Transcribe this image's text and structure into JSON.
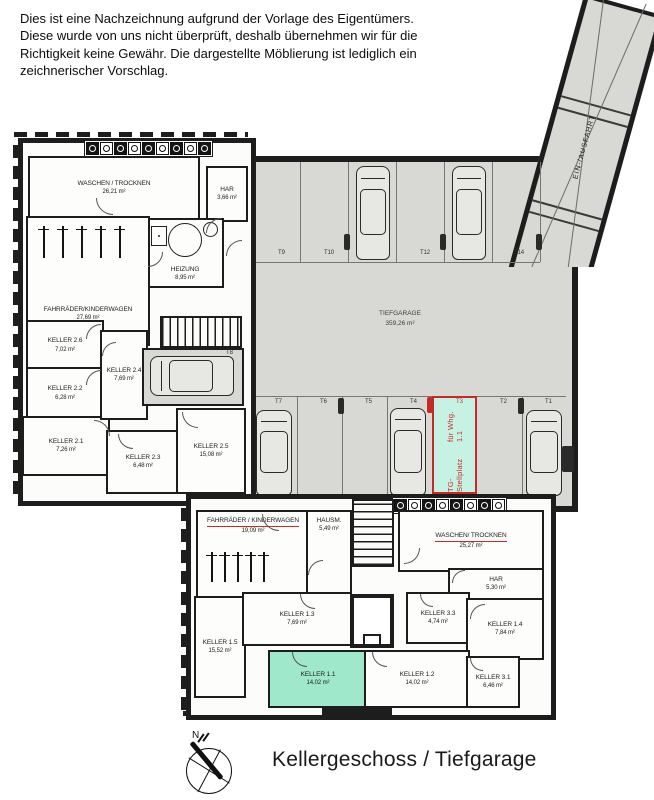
{
  "disclaimer": {
    "lines": [
      "Dies ist eine Nachzeichnung aufgrund der Vorlage des Eigentümers.",
      "Diese wurde von uns nicht überprüft, deshalb übernehmen wir für die",
      "Richtigkeit keine Gewähr. Die dargestellte Möblierung ist lediglich ein",
      "zeichnerischer Vorschlag."
    ]
  },
  "plan_title": "Kellergeschoss / Tiefgarage",
  "compass": {
    "north": "N"
  },
  "upper": {
    "rooms": [
      {
        "name": "WASCHEN / TROCKNEN",
        "area": "26,21 m²"
      },
      {
        "name": "HAR",
        "area": "3,66 m²"
      },
      {
        "name": "HEIZUNG",
        "area": "8,95 m²"
      },
      {
        "name": "FAHRRÄDER/KINDERWAGEN",
        "area": "27,69 m²"
      },
      {
        "name": "KELLER 2.6",
        "area": "7,02 m²"
      },
      {
        "name": "KELLER 2.2",
        "area": "6,28 m²"
      },
      {
        "name": "KELLER 2.1",
        "area": "7,26 m²"
      },
      {
        "name": "KELLER 2.3",
        "area": "6,48 m²"
      },
      {
        "name": "KELLER 2.4",
        "area": "7,69 m²"
      },
      {
        "name": "KELLER 2.5",
        "area": "15,08 m²"
      }
    ]
  },
  "garage": {
    "name": "TIEFGARAGE",
    "area": "359,26 m²",
    "top_stalls": [
      "T9",
      "T10",
      "T11",
      "T12",
      "T13",
      "T14"
    ],
    "bottom_stalls": [
      "T7",
      "T6",
      "T5",
      "T4",
      "T3",
      "T2",
      "T1"
    ],
    "side_stall": "T8",
    "ramp": "EIN-/AUSFAHRT",
    "highlight": {
      "stall": "T3",
      "line1": "TG-Stellplatz",
      "line2": "für Whg. 1.1"
    }
  },
  "lower": {
    "rooms": [
      {
        "name": "FAHRRÄDER / KINDERWAGEN",
        "area": "19,09 m²"
      },
      {
        "name": "HAUSM.",
        "area": "5,49 m²"
      },
      {
        "name": "WASCHEN/ TROCKNEN",
        "area": "25,27 m²"
      },
      {
        "name": "HAR",
        "area": "5,30 m²"
      },
      {
        "name": "KELLER 1.3",
        "area": "7,69 m²"
      },
      {
        "name": "KELLER 3.3",
        "area": "4,74 m²"
      },
      {
        "name": "KELLER 1.4",
        "area": "7,84 m²"
      },
      {
        "name": "KELLER 1.5",
        "area": "15,52 m²"
      },
      {
        "name": "KELLER 1.1",
        "area": "14,02 m²"
      },
      {
        "name": "KELLER 1.2",
        "area": "14,02 m²"
      },
      {
        "name": "KELLER 3.1",
        "area": "6,46 m²"
      }
    ]
  },
  "colors": {
    "wall": "#1d1d1d",
    "garage_floor": "#d8d8d4",
    "accent_red": "#c32b27",
    "highlight_stall_fill": "#c6f1e3",
    "highlight_room_fill": "#9fe8cc"
  }
}
